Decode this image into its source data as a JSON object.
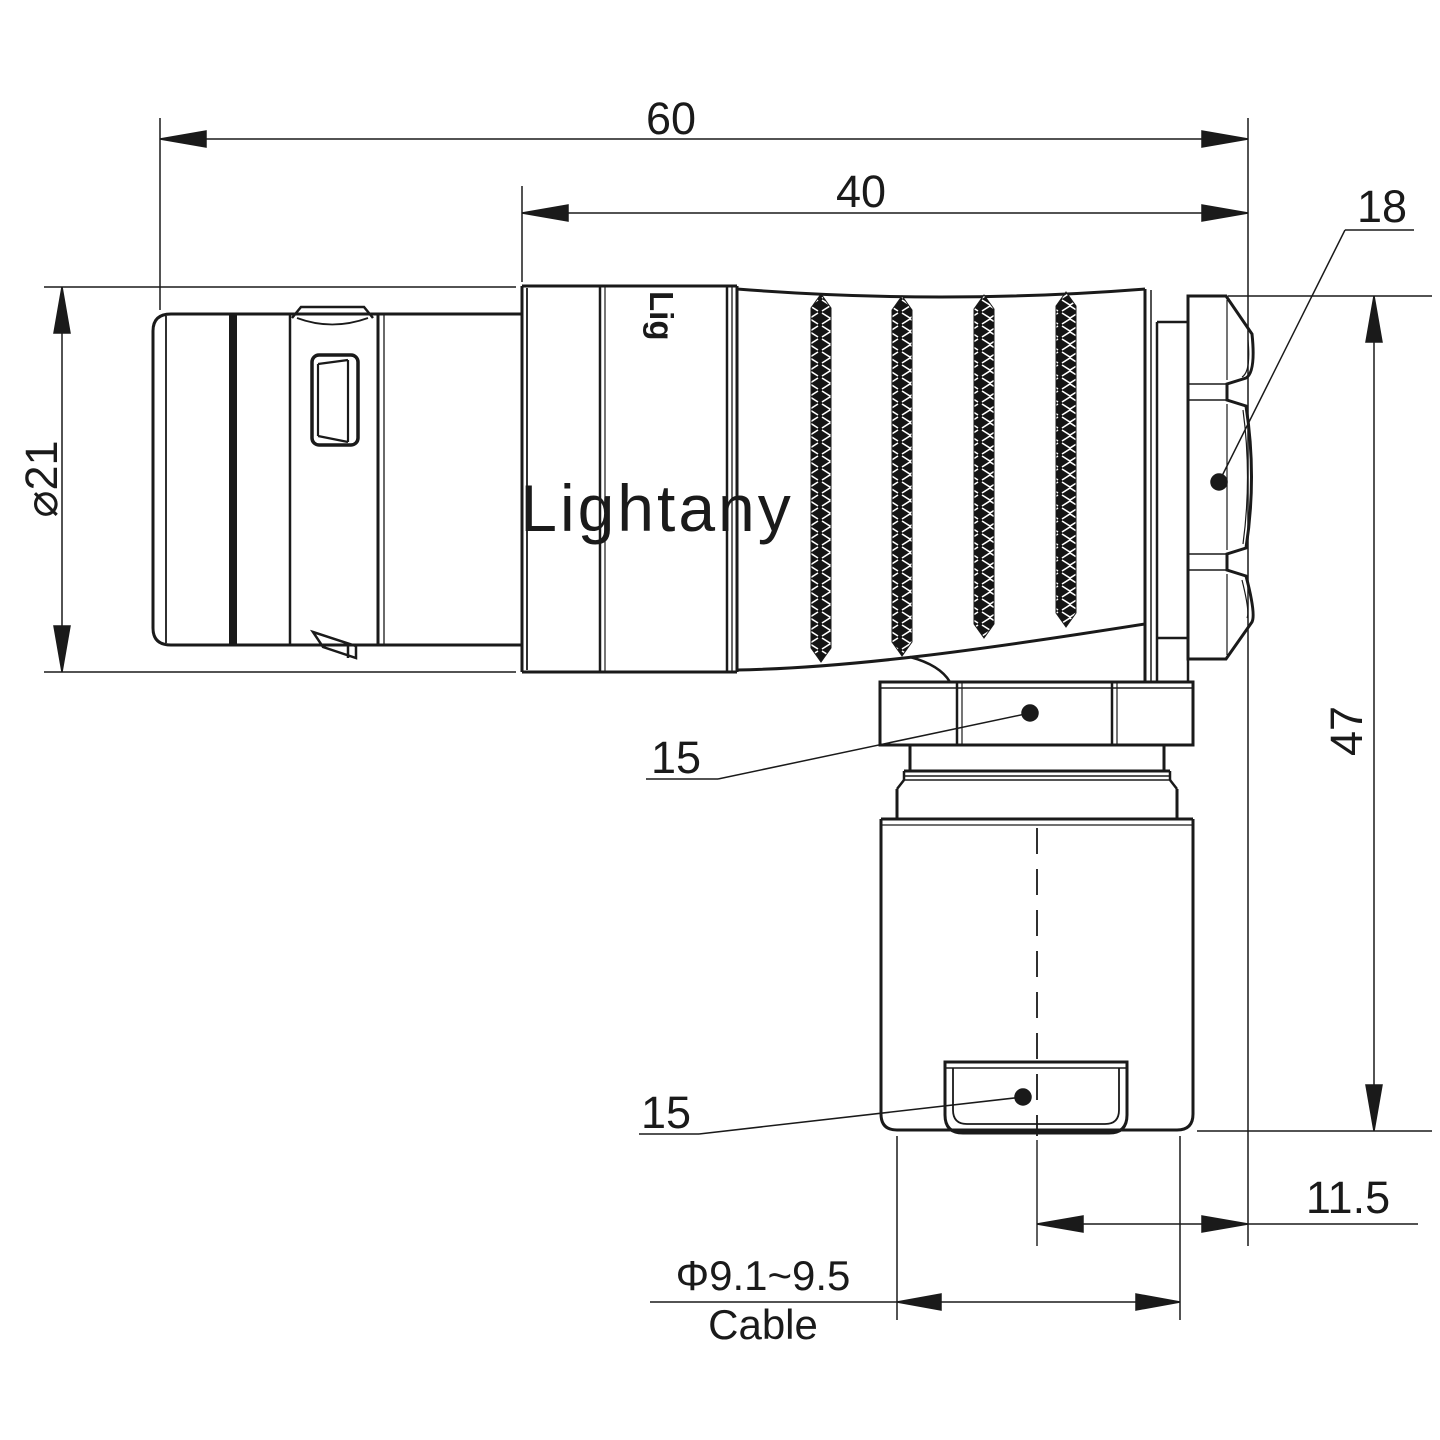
{
  "drawing": {
    "type": "connector-dimension-drawing",
    "watermark": {
      "text": "Lightany",
      "color": "#f5c9c9"
    },
    "engraving": {
      "text": "Lig"
    },
    "line_color": "#1a1a1a",
    "background": "#ffffff",
    "dimensions": {
      "overall_length": "60",
      "front_length": "40",
      "shell_diameter": "⌀21",
      "total_height": "47",
      "backnut_width": "18",
      "coupling_nut_flats": "15",
      "cable_clamp_flats": "15",
      "cable_offset": "11.5",
      "cable_diameter": "Φ9.1~9.5",
      "cable_caption": "Cable"
    }
  }
}
